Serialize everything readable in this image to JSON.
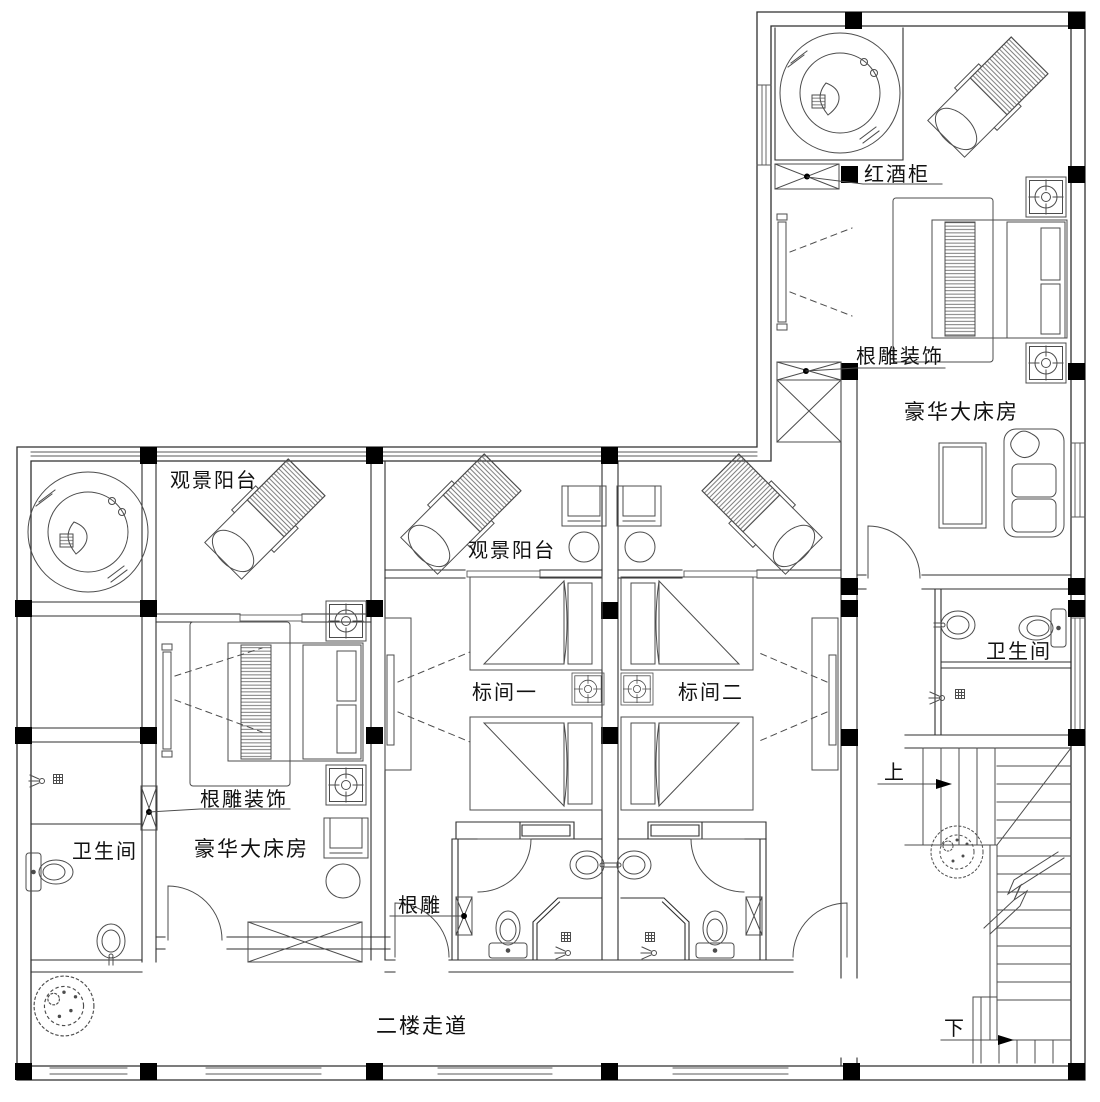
{
  "drawing": {
    "type": "floor-plan",
    "labels": {
      "wine_cabinet": "红酒柜",
      "root_decor_upper": "根雕装饰",
      "deluxe_room_upper": "豪华大床房",
      "balcony_left": "观景阳台",
      "balcony_center": "观景阳台",
      "root_decor_left": "根雕装饰",
      "deluxe_room_left": "豪华大床房",
      "std_room_1": "标间一",
      "std_room_2": "标间二",
      "bathroom_left": "卫生间",
      "bathroom_right": "卫生间",
      "root_carving": "根雕",
      "stairs_up": "上",
      "stairs_down": "下",
      "corridor": "二楼走道"
    },
    "colors": {
      "wall": "#2f2f2f",
      "furniture": "#4c4c4c",
      "window": "#5a5a5a",
      "column": "#000000",
      "text": "#111111",
      "background": "#ffffff"
    }
  }
}
